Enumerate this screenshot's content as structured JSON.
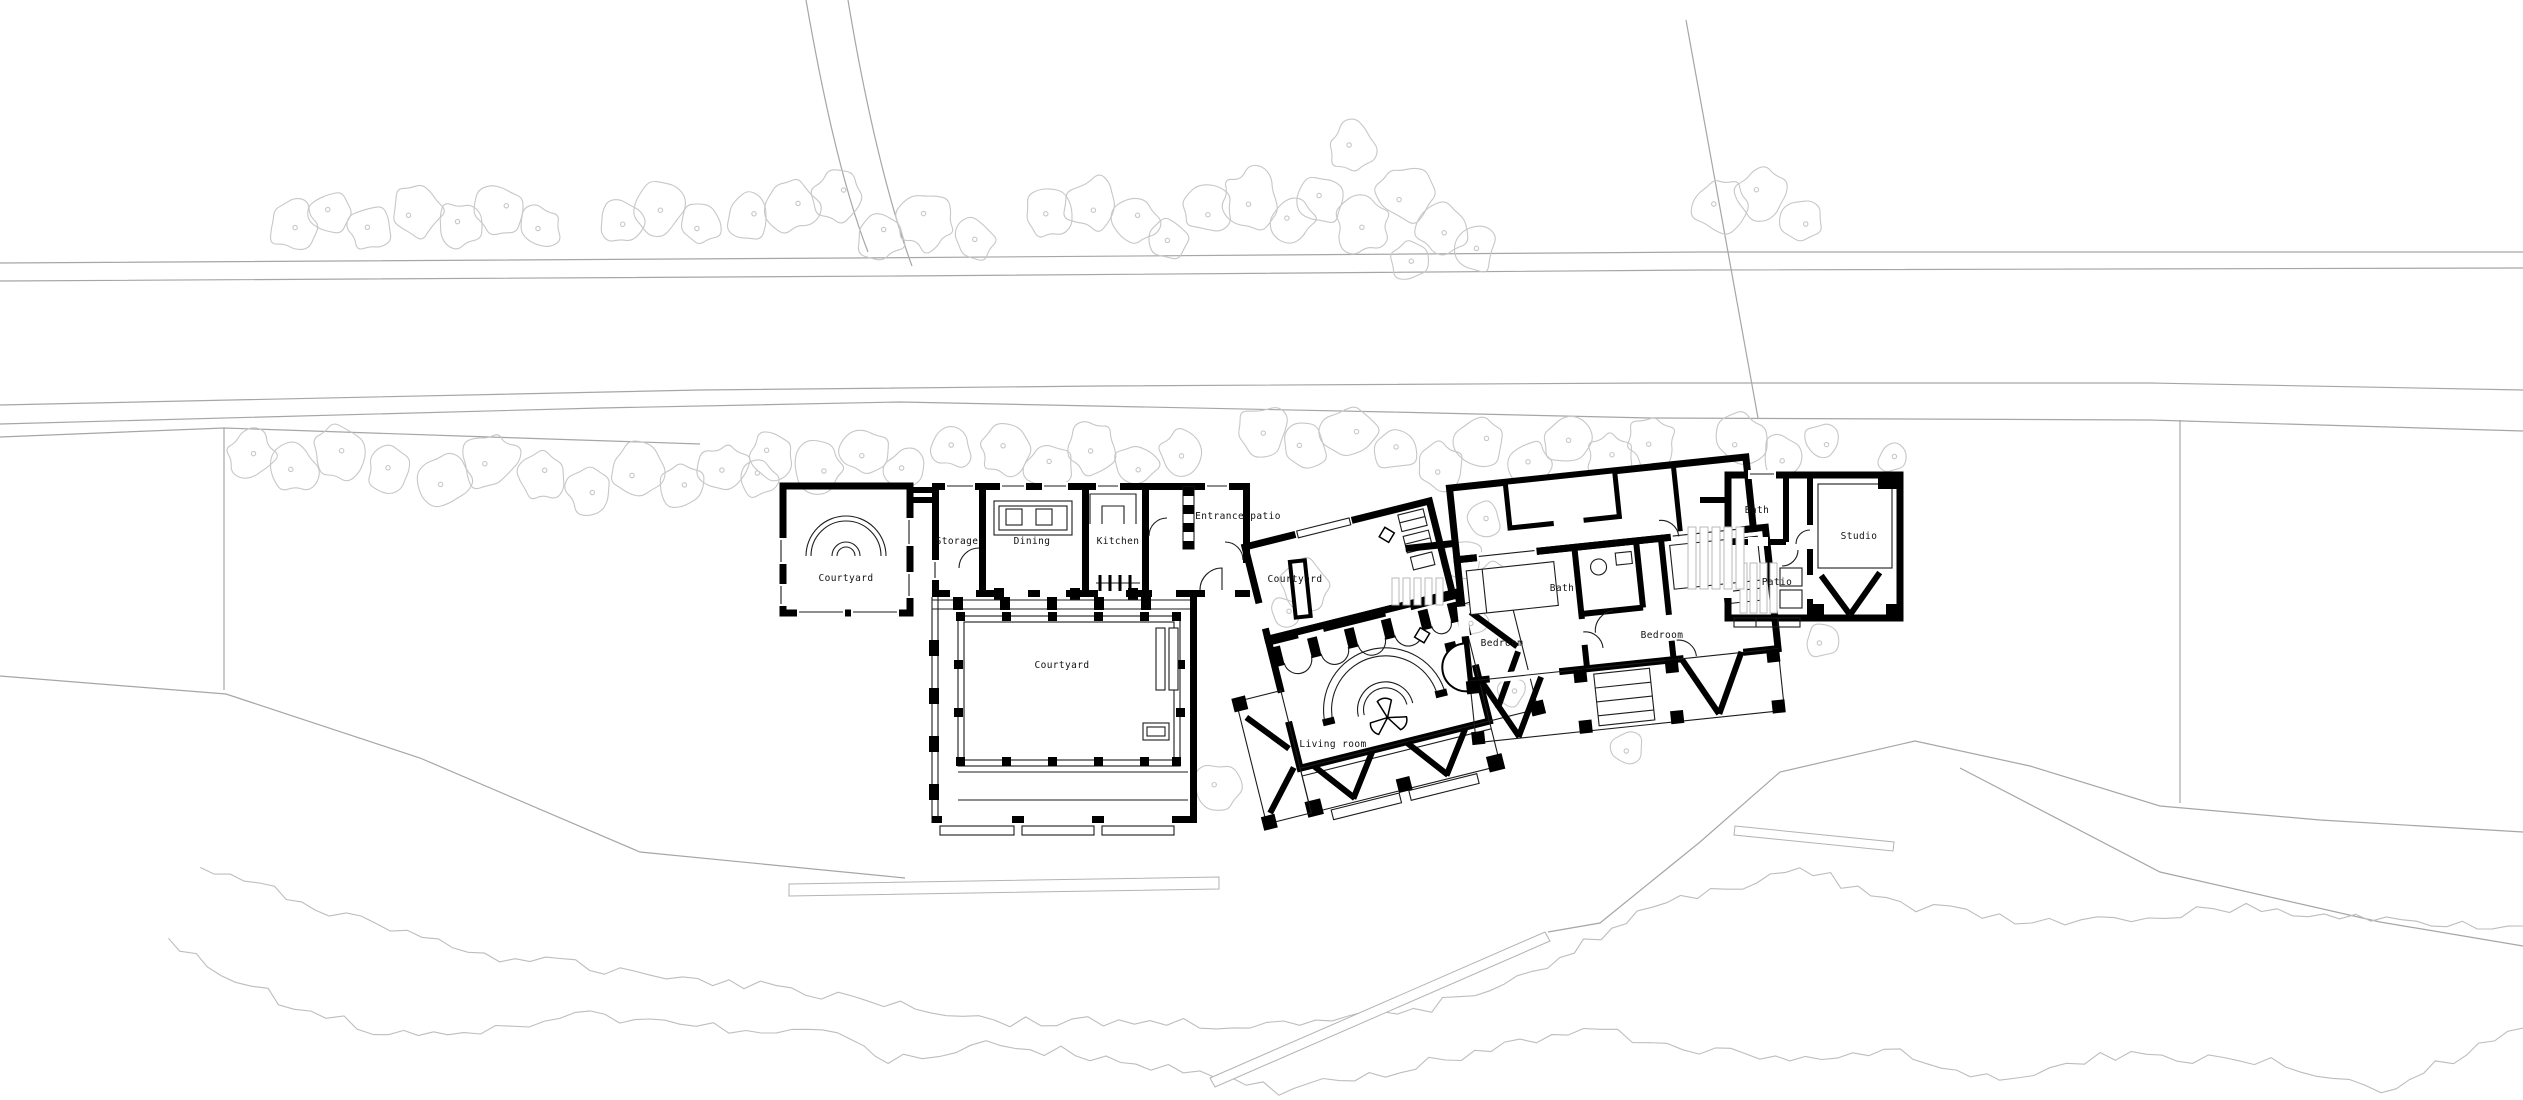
{
  "title": "Site floor plan",
  "labels": {
    "courtyard_west": "Courtyard",
    "storage": "Storage",
    "dining": "Dining",
    "kitchen": "Kitchen",
    "entrance_patio": "Entrance patio",
    "courtyard_main": "Courtyard",
    "courtyard_small": "Courtyard",
    "living_room": "Living room",
    "bedroom_west": "Bedroom",
    "bath_main": "Bath",
    "bedroom_east": "Bedroom",
    "bath_studio": "Bath",
    "studio": "Studio",
    "patio_studio": "Patio"
  },
  "colors": {
    "wall": "#000000",
    "background": "#ffffff",
    "site_line": "#a6a6a6",
    "contour_line": "#bdbdbd",
    "tree_line": "#c7c7c7",
    "label_text": "#111111"
  }
}
